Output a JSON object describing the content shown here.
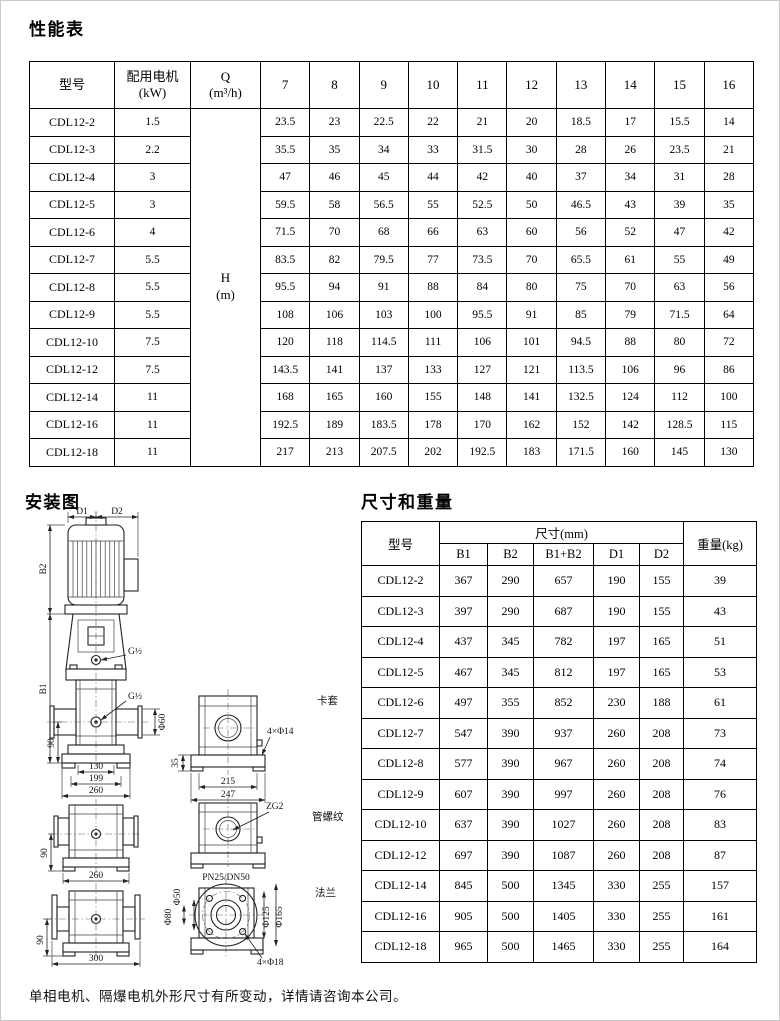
{
  "page": {
    "performance_title": "性能表",
    "installation_title": "安装图",
    "dimensions_title": "尺寸和重量",
    "footer_note": "单相电机、隔爆电机外形尺寸有所变动，详情请咨询本公司。"
  },
  "performance_table": {
    "col_model": "型号",
    "col_motor": "配用电机",
    "col_motor_unit": "(kW)",
    "col_q": "Q",
    "col_q_unit": "(m³/h)",
    "flow_columns": [
      "7",
      "8",
      "9",
      "10",
      "11",
      "12",
      "13",
      "14",
      "15",
      "16"
    ],
    "h_label": "H",
    "h_unit": "(m)",
    "rows": [
      {
        "model": "CDL12-2",
        "kw": "1.5",
        "values": [
          "23.5",
          "23",
          "22.5",
          "22",
          "21",
          "20",
          "18.5",
          "17",
          "15.5",
          "14"
        ]
      },
      {
        "model": "CDL12-3",
        "kw": "2.2",
        "values": [
          "35.5",
          "35",
          "34",
          "33",
          "31.5",
          "30",
          "28",
          "26",
          "23.5",
          "21"
        ]
      },
      {
        "model": "CDL12-4",
        "kw": "3",
        "values": [
          "47",
          "46",
          "45",
          "44",
          "42",
          "40",
          "37",
          "34",
          "31",
          "28"
        ]
      },
      {
        "model": "CDL12-5",
        "kw": "3",
        "values": [
          "59.5",
          "58",
          "56.5",
          "55",
          "52.5",
          "50",
          "46.5",
          "43",
          "39",
          "35"
        ]
      },
      {
        "model": "CDL12-6",
        "kw": "4",
        "values": [
          "71.5",
          "70",
          "68",
          "66",
          "63",
          "60",
          "56",
          "52",
          "47",
          "42"
        ]
      },
      {
        "model": "CDL12-7",
        "kw": "5.5",
        "values": [
          "83.5",
          "82",
          "79.5",
          "77",
          "73.5",
          "70",
          "65.5",
          "61",
          "55",
          "49"
        ]
      },
      {
        "model": "CDL12-8",
        "kw": "5.5",
        "values": [
          "95.5",
          "94",
          "91",
          "88",
          "84",
          "80",
          "75",
          "70",
          "63",
          "56"
        ]
      },
      {
        "model": "CDL12-9",
        "kw": "5.5",
        "values": [
          "108",
          "106",
          "103",
          "100",
          "95.5",
          "91",
          "85",
          "79",
          "71.5",
          "64"
        ]
      },
      {
        "model": "CDL12-10",
        "kw": "7.5",
        "values": [
          "120",
          "118",
          "114.5",
          "111",
          "106",
          "101",
          "94.5",
          "88",
          "80",
          "72"
        ]
      },
      {
        "model": "CDL12-12",
        "kw": "7.5",
        "values": [
          "143.5",
          "141",
          "137",
          "133",
          "127",
          "121",
          "113.5",
          "106",
          "96",
          "86"
        ]
      },
      {
        "model": "CDL12-14",
        "kw": "11",
        "values": [
          "168",
          "165",
          "160",
          "155",
          "148",
          "141",
          "132.5",
          "124",
          "112",
          "100"
        ]
      },
      {
        "model": "CDL12-16",
        "kw": "11",
        "values": [
          "192.5",
          "189",
          "183.5",
          "178",
          "170",
          "162",
          "152",
          "142",
          "128.5",
          "115"
        ]
      },
      {
        "model": "CDL12-18",
        "kw": "11",
        "values": [
          "217",
          "213",
          "207.5",
          "202",
          "192.5",
          "183",
          "171.5",
          "160",
          "145",
          "130"
        ]
      }
    ]
  },
  "dimensions_table": {
    "col_model": "型号",
    "col_size_group": "尺寸(mm)",
    "col_weight": "重量(kg)",
    "size_columns": [
      "B1",
      "B2",
      "B1+B2",
      "D1",
      "D2"
    ],
    "rows": [
      {
        "model": "CDL12-2",
        "values": [
          "367",
          "290",
          "657",
          "190",
          "155"
        ],
        "weight": "39"
      },
      {
        "model": "CDL12-3",
        "values": [
          "397",
          "290",
          "687",
          "190",
          "155"
        ],
        "weight": "43"
      },
      {
        "model": "CDL12-4",
        "values": [
          "437",
          "345",
          "782",
          "197",
          "165"
        ],
        "weight": "51"
      },
      {
        "model": "CDL12-5",
        "values": [
          "467",
          "345",
          "812",
          "197",
          "165"
        ],
        "weight": "53"
      },
      {
        "model": "CDL12-6",
        "values": [
          "497",
          "355",
          "852",
          "230",
          "188"
        ],
        "weight": "61"
      },
      {
        "model": "CDL12-7",
        "values": [
          "547",
          "390",
          "937",
          "260",
          "208"
        ],
        "weight": "73"
      },
      {
        "model": "CDL12-8",
        "values": [
          "577",
          "390",
          "967",
          "260",
          "208"
        ],
        "weight": "74"
      },
      {
        "model": "CDL12-9",
        "values": [
          "607",
          "390",
          "997",
          "260",
          "208"
        ],
        "weight": "76"
      },
      {
        "model": "CDL12-10",
        "values": [
          "637",
          "390",
          "1027",
          "260",
          "208"
        ],
        "weight": "83"
      },
      {
        "model": "CDL12-12",
        "values": [
          "697",
          "390",
          "1087",
          "260",
          "208"
        ],
        "weight": "87"
      },
      {
        "model": "CDL12-14",
        "values": [
          "845",
          "500",
          "1345",
          "330",
          "255"
        ],
        "weight": "157"
      },
      {
        "model": "CDL12-16",
        "values": [
          "905",
          "500",
          "1405",
          "330",
          "255"
        ],
        "weight": "161"
      },
      {
        "model": "CDL12-18",
        "values": [
          "965",
          "500",
          "1465",
          "330",
          "255"
        ],
        "weight": "164"
      }
    ]
  },
  "diagram": {
    "labels": {
      "d1": "D1",
      "d2": "D2",
      "b2": "B2",
      "b1": "B1",
      "g_half_1": "G½",
      "g_half_2": "G½",
      "phi60": "Φ60",
      "dim90_main": "90",
      "dim130": "130",
      "dim199": "199",
      "dim260_main": "260",
      "dim35": "35",
      "dim215": "215",
      "dim247": "247",
      "holes_14": "4×Φ14",
      "clamp": "卡套",
      "zg2": "ZG2",
      "thread": "管螺纹",
      "dim90_mid": "90",
      "dim260_mid": "260",
      "pn": "PN25/DN50",
      "phi50": "Φ50",
      "phi80": "Φ80",
      "phi125": "Φ125",
      "phi165": "Φ165",
      "holes_18": "4×Φ18",
      "flange": "法兰",
      "dim90_bot": "90",
      "dim300": "300"
    }
  }
}
